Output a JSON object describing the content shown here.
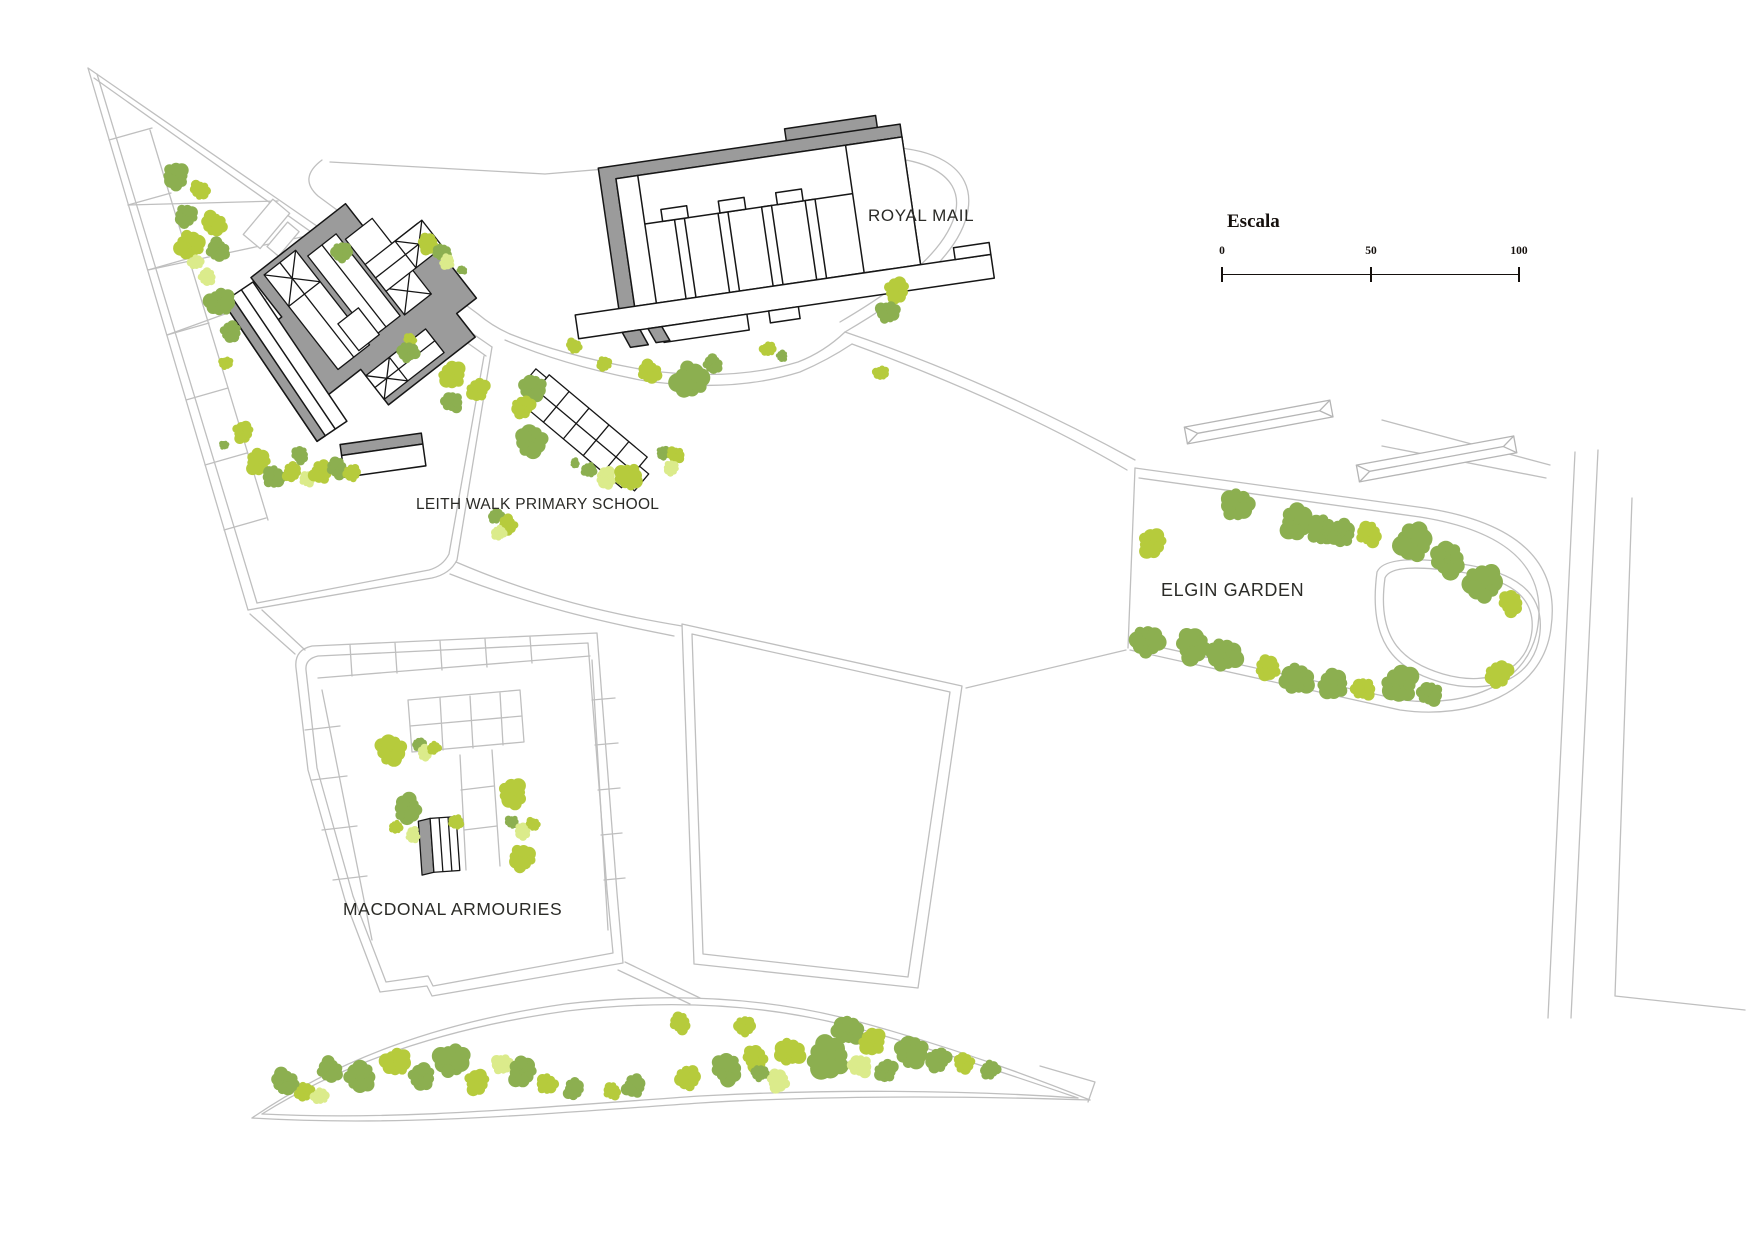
{
  "canvas": {
    "width": 1754,
    "height": 1240,
    "background": "#FFFFFF"
  },
  "labels": [
    {
      "id": "royal-mail",
      "text": "ROYAL MAIL"
    },
    {
      "id": "school",
      "text": "LEITH WALK PRIMARY SCHOOL"
    },
    {
      "id": "garden",
      "text": "ELGIN GARDEN"
    },
    {
      "id": "armouries",
      "text": "MACDONAL ARMOURIES"
    }
  ],
  "scale_bar": {
    "title": "Escala",
    "ticks": [
      {
        "label": "0",
        "x": 1222
      },
      {
        "label": "50",
        "x": 1371
      },
      {
        "label": "100",
        "x": 1519
      }
    ]
  },
  "palette": {
    "tree_olive": "#8CAF50",
    "tree_lime": "#B6CB3C",
    "tree_pale": "#DBEB8B",
    "building_fill": "#9B9B9B",
    "building_outline": "#161616",
    "parcel_line": "#BFBFBF",
    "label_color": "#2B2B27"
  },
  "tree_colors": {
    "o": "#8CAF50",
    "l": "#B6CB3C",
    "p": "#DBEB8B"
  },
  "trees": [
    [
      176,
      176,
      14,
      "o"
    ],
    [
      200,
      190,
      10,
      "l"
    ],
    [
      186,
      216,
      12,
      "o"
    ],
    [
      214,
      224,
      13,
      "l"
    ],
    [
      190,
      245,
      15,
      "l"
    ],
    [
      218,
      250,
      12,
      "o"
    ],
    [
      196,
      262,
      8,
      "p"
    ],
    [
      207,
      277,
      9,
      "p"
    ],
    [
      220,
      302,
      15,
      "o"
    ],
    [
      231,
      332,
      11,
      "o"
    ],
    [
      226,
      363,
      7,
      "l"
    ],
    [
      243,
      432,
      11,
      "l"
    ],
    [
      224,
      445,
      5,
      "o"
    ],
    [
      258,
      462,
      13,
      "l"
    ],
    [
      274,
      477,
      12,
      "o"
    ],
    [
      292,
      472,
      10,
      "l"
    ],
    [
      307,
      479,
      8,
      "p"
    ],
    [
      321,
      472,
      12,
      "l"
    ],
    [
      337,
      468,
      11,
      "o"
    ],
    [
      352,
      473,
      9,
      "l"
    ],
    [
      300,
      455,
      9,
      "o"
    ],
    [
      342,
      252,
      11,
      "o"
    ],
    [
      410,
      340,
      7,
      "l"
    ],
    [
      408,
      352,
      11,
      "o"
    ],
    [
      428,
      244,
      11,
      "l"
    ],
    [
      442,
      252,
      9,
      "o"
    ],
    [
      447,
      262,
      8,
      "p"
    ],
    [
      462,
      270,
      5,
      "o"
    ],
    [
      452,
      375,
      14,
      "l"
    ],
    [
      452,
      402,
      11,
      "o"
    ],
    [
      478,
      390,
      12,
      "l"
    ],
    [
      533,
      388,
      14,
      "o"
    ],
    [
      523,
      407,
      12,
      "l"
    ],
    [
      531,
      441,
      17,
      "o"
    ],
    [
      496,
      516,
      8,
      "o"
    ],
    [
      508,
      525,
      10,
      "l"
    ],
    [
      499,
      533,
      8,
      "p"
    ],
    [
      575,
      463,
      5,
      "o"
    ],
    [
      589,
      470,
      8,
      "o"
    ],
    [
      606,
      478,
      11,
      "p"
    ],
    [
      629,
      477,
      14,
      "l"
    ],
    [
      663,
      453,
      7,
      "o"
    ],
    [
      676,
      455,
      9,
      "l"
    ],
    [
      671,
      468,
      8,
      "p"
    ],
    [
      574,
      346,
      8,
      "l"
    ],
    [
      604,
      364,
      8,
      "l"
    ],
    [
      650,
      372,
      12,
      "l"
    ],
    [
      690,
      380,
      19,
      "o"
    ],
    [
      713,
      364,
      10,
      "o"
    ],
    [
      768,
      349,
      8,
      "l"
    ],
    [
      782,
      356,
      6,
      "o"
    ],
    [
      881,
      373,
      8,
      "l"
    ],
    [
      897,
      290,
      13,
      "l"
    ],
    [
      888,
      312,
      12,
      "o"
    ],
    [
      1152,
      543,
      15,
      "l"
    ],
    [
      1237,
      505,
      17,
      "o"
    ],
    [
      1297,
      522,
      18,
      "o"
    ],
    [
      1322,
      530,
      16,
      "o"
    ],
    [
      1342,
      533,
      14,
      "o"
    ],
    [
      1369,
      534,
      13,
      "l"
    ],
    [
      1413,
      542,
      20,
      "o"
    ],
    [
      1448,
      560,
      18,
      "o"
    ],
    [
      1483,
      583,
      20,
      "o"
    ],
    [
      1511,
      603,
      13,
      "l"
    ],
    [
      1147,
      641,
      17,
      "o"
    ],
    [
      1193,
      646,
      18,
      "o"
    ],
    [
      1224,
      655,
      18,
      "o"
    ],
    [
      1268,
      668,
      13,
      "l"
    ],
    [
      1297,
      679,
      17,
      "o"
    ],
    [
      1333,
      684,
      16,
      "o"
    ],
    [
      1363,
      689,
      12,
      "l"
    ],
    [
      1400,
      684,
      19,
      "o"
    ],
    [
      1430,
      694,
      13,
      "o"
    ],
    [
      1499,
      674,
      14,
      "l"
    ],
    [
      391,
      750,
      16,
      "l"
    ],
    [
      419,
      744,
      7,
      "o"
    ],
    [
      425,
      753,
      8,
      "p"
    ],
    [
      434,
      748,
      7,
      "l"
    ],
    [
      408,
      809,
      15,
      "o"
    ],
    [
      396,
      827,
      7,
      "l"
    ],
    [
      413,
      835,
      8,
      "p"
    ],
    [
      456,
      822,
      8,
      "l"
    ],
    [
      513,
      794,
      15,
      "l"
    ],
    [
      512,
      822,
      7,
      "o"
    ],
    [
      523,
      831,
      9,
      "p"
    ],
    [
      533,
      824,
      7,
      "l"
    ],
    [
      522,
      858,
      14,
      "l"
    ],
    [
      285,
      1082,
      14,
      "o"
    ],
    [
      305,
      1092,
      10,
      "l"
    ],
    [
      330,
      1070,
      13,
      "o"
    ],
    [
      320,
      1096,
      9,
      "p"
    ],
    [
      360,
      1077,
      16,
      "o"
    ],
    [
      396,
      1062,
      15,
      "l"
    ],
    [
      422,
      1077,
      14,
      "o"
    ],
    [
      452,
      1060,
      18,
      "o"
    ],
    [
      477,
      1082,
      13,
      "l"
    ],
    [
      502,
      1064,
      11,
      "p"
    ],
    [
      522,
      1072,
      15,
      "o"
    ],
    [
      547,
      1084,
      11,
      "l"
    ],
    [
      574,
      1089,
      11,
      "o"
    ],
    [
      612,
      1091,
      9,
      "l"
    ],
    [
      634,
      1086,
      12,
      "o"
    ],
    [
      680,
      1023,
      11,
      "l"
    ],
    [
      688,
      1078,
      13,
      "l"
    ],
    [
      727,
      1069,
      16,
      "o"
    ],
    [
      745,
      1026,
      11,
      "l"
    ],
    [
      755,
      1058,
      13,
      "l"
    ],
    [
      760,
      1073,
      9,
      "o"
    ],
    [
      778,
      1081,
      12,
      "p"
    ],
    [
      790,
      1052,
      15,
      "l"
    ],
    [
      828,
      1058,
      22,
      "o"
    ],
    [
      848,
      1030,
      16,
      "o"
    ],
    [
      872,
      1042,
      14,
      "l"
    ],
    [
      860,
      1066,
      12,
      "p"
    ],
    [
      886,
      1071,
      12,
      "o"
    ],
    [
      912,
      1052,
      17,
      "o"
    ],
    [
      938,
      1060,
      13,
      "o"
    ],
    [
      964,
      1063,
      11,
      "l"
    ],
    [
      990,
      1070,
      10,
      "o"
    ]
  ]
}
